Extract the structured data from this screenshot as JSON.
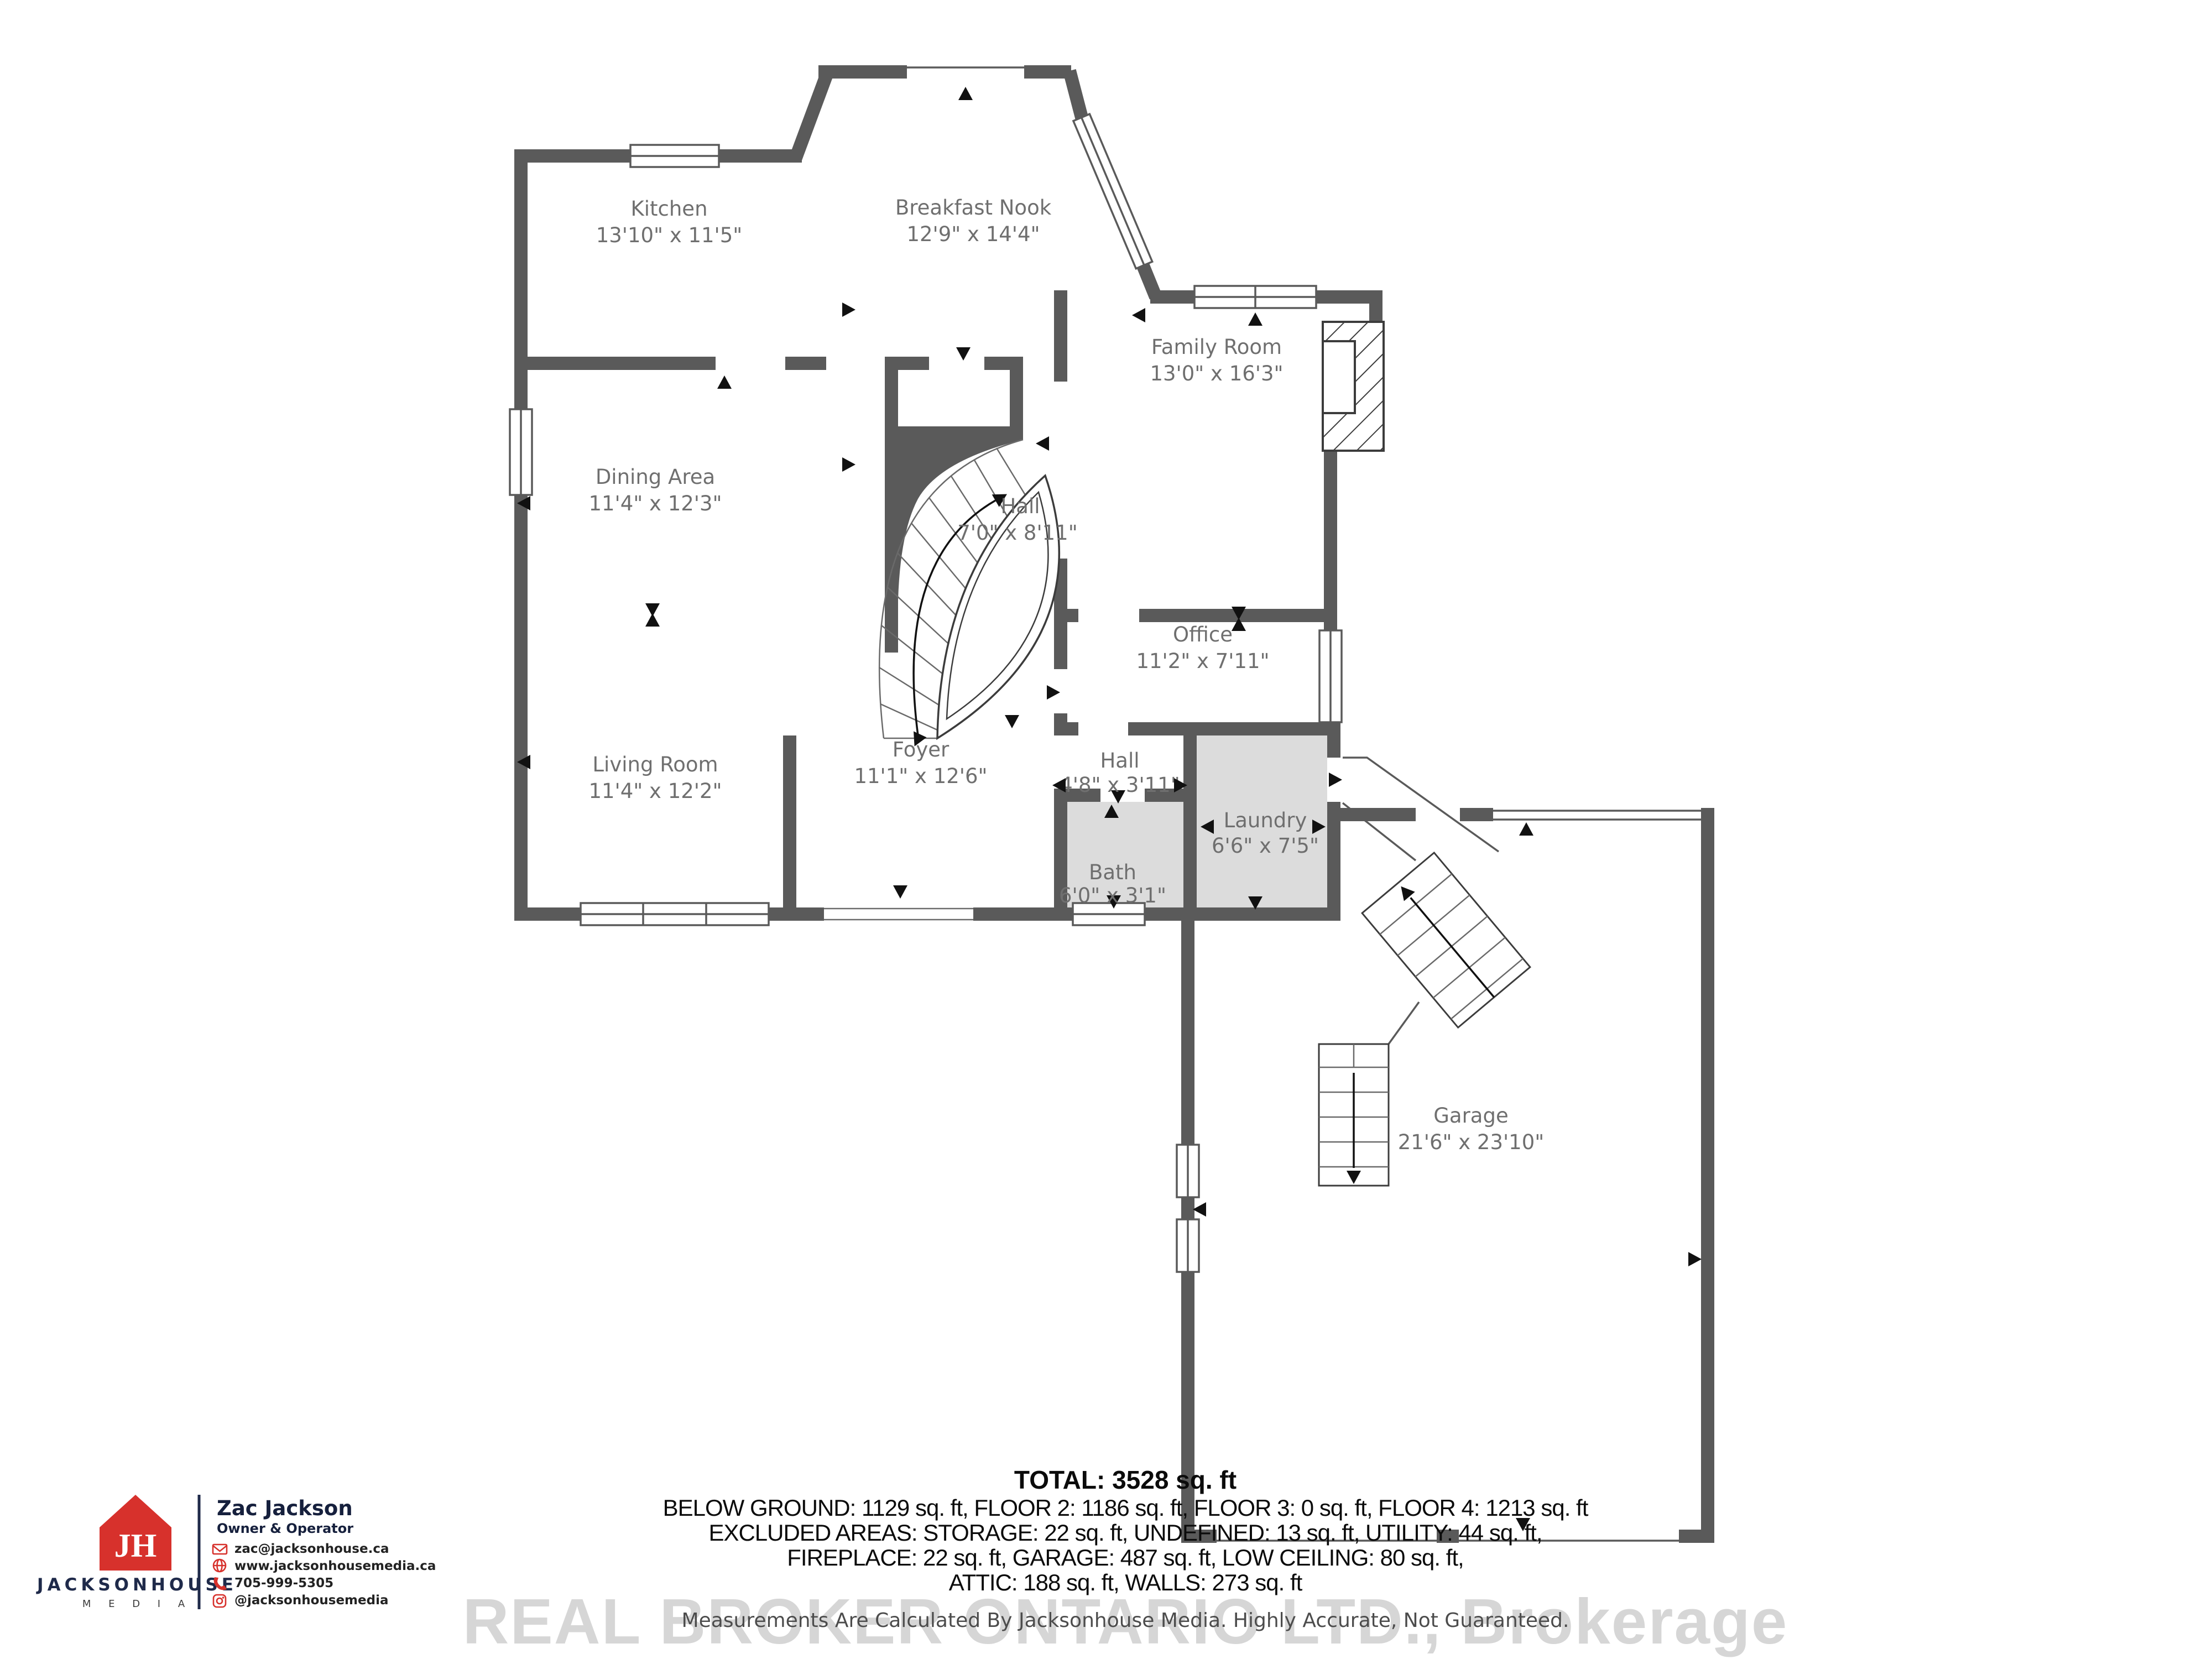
{
  "plan": {
    "rooms": {
      "kitchen": {
        "name": "Kitchen",
        "dims": "13'10\" x 11'5\""
      },
      "breakfast_nook": {
        "name": "Breakfast Nook",
        "dims": "12'9\" x 14'4\""
      },
      "family_room": {
        "name": "Family Room",
        "dims": "13'0\" x 16'3\""
      },
      "dining_area": {
        "name": "Dining Area",
        "dims": "11'4\" x 12'3\""
      },
      "hall_main": {
        "name": "Hall",
        "dims": "7'0\" x 8'11\""
      },
      "office": {
        "name": "Office",
        "dims": "11'2\" x 7'11\""
      },
      "living_room": {
        "name": "Living Room",
        "dims": "11'4\" x 12'2\""
      },
      "foyer": {
        "name": "Foyer",
        "dims": "11'1\" x 12'6\""
      },
      "hall_small": {
        "name": "Hall",
        "dims": "4'8\" x 3'11\""
      },
      "laundry": {
        "name": "Laundry",
        "dims": "6'6\" x 7'5\""
      },
      "bath": {
        "name": "Bath",
        "dims": "6'0\" x 3'1\""
      },
      "garage": {
        "name": "Garage",
        "dims": "21'6\" x 23'10\""
      }
    }
  },
  "summary": {
    "total": "TOTAL: 3528 sq. ft",
    "line1": "BELOW GROUND: 1129 sq. ft, FLOOR 2: 1186 sq. ft, FLOOR 3: 0 sq. ft, FLOOR 4: 1213 sq. ft",
    "line2": "EXCLUDED AREAS: STORAGE: 22 sq. ft, UNDEFINED: 13 sq. ft, UTILITY: 44 sq. ft,",
    "line3": "FIREPLACE: 22 sq. ft, GARAGE: 487 sq. ft, LOW CEILING: 80 sq. ft,",
    "line4": "ATTIC: 188 sq. ft, WALLS: 273 sq. ft"
  },
  "watermark": {
    "brokerage": "REAL BROKER ONTARIO LTD., Brokerage",
    "disclaimer": "Measurements Are Calculated By Jacksonhouse Media. Highly Accurate, Not Guaranteed."
  },
  "brand": {
    "monogram": "JH",
    "company": "JACKSONHOUSE",
    "division": "M E D I A",
    "agent_name": "Zac Jackson",
    "agent_title": "Owner & Operator",
    "email": "zac@jacksonhouse.ca",
    "website": "www.jacksonhousemedia.ca",
    "phone": "705-999-5305",
    "instagram": "@jacksonhousemedia",
    "colors": {
      "red": "#d7312c",
      "navy": "#1f2a4a"
    }
  }
}
